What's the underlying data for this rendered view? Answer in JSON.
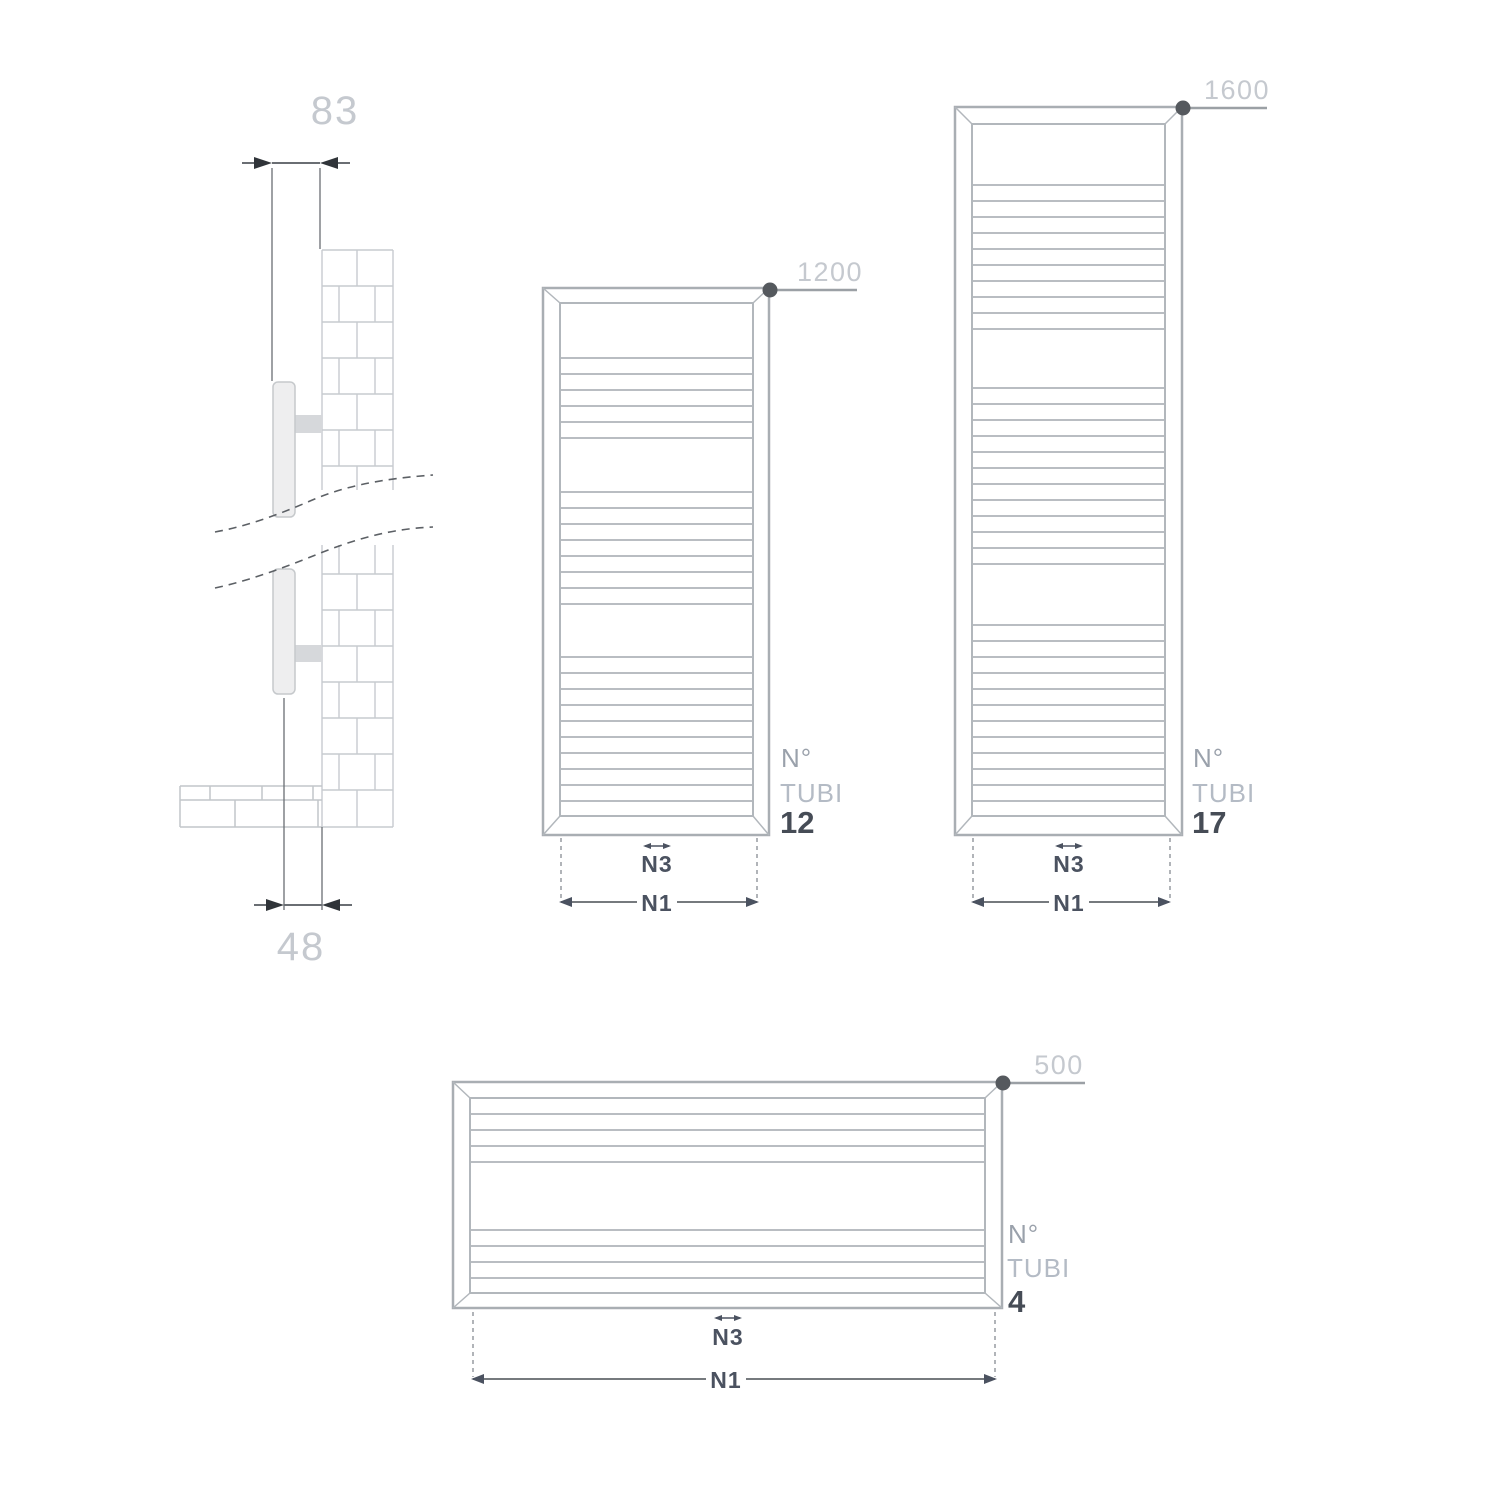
{
  "side_view": {
    "dim_depth_total": "83",
    "dim_depth_from_wall": "48"
  },
  "radiators": [
    {
      "height_dim": "1200",
      "n_label": "N°",
      "tubi_label": "TUBI",
      "tube_count": "12",
      "n3_label": "N3",
      "n1_label": "N1"
    },
    {
      "height_dim": "1600",
      "n_label": "N°",
      "tubi_label": "TUBI",
      "tube_count": "17",
      "n3_label": "N3",
      "n1_label": "N1"
    },
    {
      "height_dim": "500",
      "n_label": "N°",
      "tubi_label": "TUBI",
      "tube_count": "4",
      "n3_label": "N3",
      "n1_label": "N1"
    }
  ],
  "colors": {
    "drawing_outline": "#a9aeb3",
    "rung_line": "#b9bdc2",
    "brick_line": "#c7cbcf",
    "dim_line_dark": "#6a6e73",
    "dim_arrow_dark": "#303439",
    "height_dim_line": "#9ba0a5",
    "corner_marker_dot": "#55595e",
    "dim_label_light": "#c5c9cf",
    "n_label_gray": "#9aa1ab",
    "tubi_label_gray": "#b4bbc5",
    "tube_count_dark": "#464c56",
    "n_dim_label": "#4b5260"
  }
}
